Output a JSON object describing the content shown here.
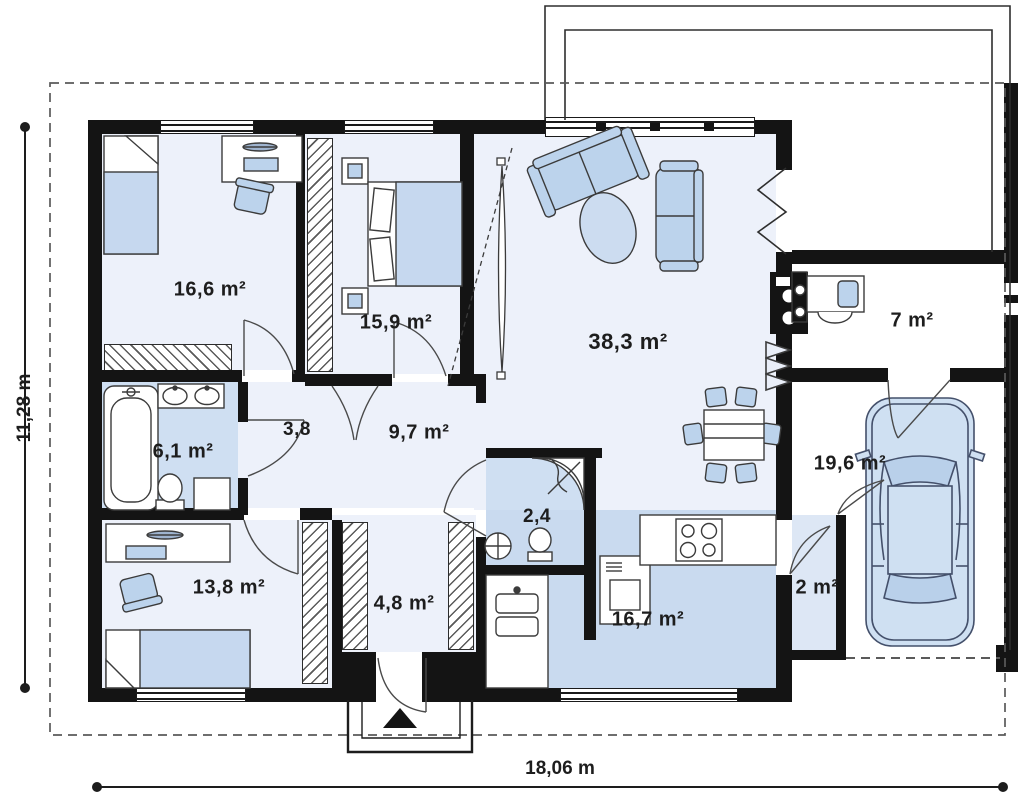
{
  "plan": {
    "type": "single-storey-house-floor-plan",
    "dimensions": {
      "width_label": "18,06 m",
      "height_label": "11,28 m"
    },
    "rooms": [
      {
        "id": "bedroom-top-left",
        "area": "16,6 m²"
      },
      {
        "id": "bedroom-top-middle",
        "area": "15,9 m²"
      },
      {
        "id": "living-room",
        "area": "38,3 m²"
      },
      {
        "id": "utility-room",
        "area": "7 m²"
      },
      {
        "id": "hall",
        "area": "3,8"
      },
      {
        "id": "bathroom",
        "area": "6,1 m²"
      },
      {
        "id": "corridor",
        "area": "9,7 m²"
      },
      {
        "id": "wc-shower-room",
        "area": "2,4"
      },
      {
        "id": "garage",
        "area": "19,6 m²"
      },
      {
        "id": "bedroom-bottom-left",
        "area": "13,8 m²"
      },
      {
        "id": "wardrobe-vestibule",
        "area": "4,8 m²"
      },
      {
        "id": "storage",
        "area": "2 m²"
      },
      {
        "id": "kitchen-dining",
        "area": "16,7 m²"
      }
    ],
    "furniture_icons": [
      "single-bed",
      "double-bed",
      "desk",
      "desk-chair",
      "wardrobe-rack",
      "sofa",
      "armchair-sofa",
      "oval-rug",
      "dining-table",
      "dining-chair",
      "fireplace",
      "radiator",
      "bathtub",
      "double-washbasin",
      "toilet",
      "washing-machine",
      "corner-shower",
      "washbasin",
      "kitchen-sink",
      "oven",
      "kitchen-hob",
      "car",
      "entrance-arrow",
      "door-swing"
    ],
    "colors": {
      "wall": "#141414",
      "room_floor": "#edf1fa",
      "wet_room_floor": "#cfdff2",
      "kitchen_floor": "#c9daef",
      "furniture_fill": "#bcd3ec",
      "background": "#ffffff"
    }
  }
}
